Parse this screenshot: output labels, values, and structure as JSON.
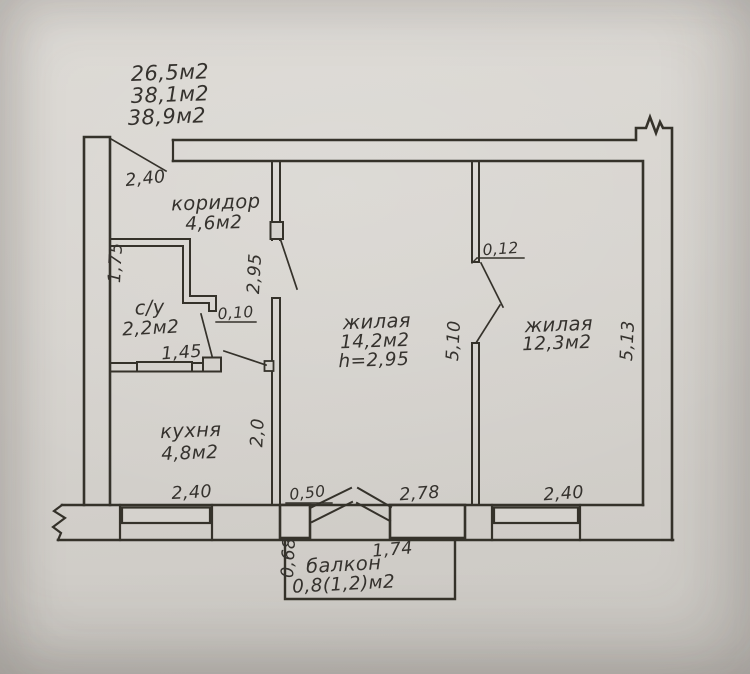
{
  "summary_areas": {
    "line1": "26,5м2",
    "line2": "38,1м2",
    "line3": "38,9м2"
  },
  "rooms": {
    "corridor": {
      "name": "коридор",
      "area": "4,6м2"
    },
    "bathroom": {
      "name": "с/у",
      "area": "2,2м2"
    },
    "kitchen": {
      "name": "кухня",
      "area": "4,8м2"
    },
    "living1": {
      "name": "жилая",
      "area": "14,2м2",
      "ceiling": "h=2,95"
    },
    "living2": {
      "name": "жилая",
      "area": "12,3м2"
    },
    "balcony": {
      "name": "балкон",
      "area": "0,8(1,2)м2"
    }
  },
  "dimensions": {
    "entry_width": "2,40",
    "corridor_depth": "2,95",
    "bathroom_left_side": "1,75",
    "partition_thickness_a": "0,10",
    "bathroom_width": "1,45",
    "kitchen_depth": "2,0",
    "kitchen_window_width": "2,40",
    "pier_width": "0,50",
    "balcony_block_width": "2,78",
    "living2_window_width": "2,40",
    "living1_depth": "5,10",
    "living2_depth": "5,13",
    "partition_thickness_b": "0,12",
    "balcony_width": "1,74",
    "balcony_depth": "0,68"
  },
  "colors": {
    "paper": "#d6d3ce",
    "ink": "#34312c"
  }
}
